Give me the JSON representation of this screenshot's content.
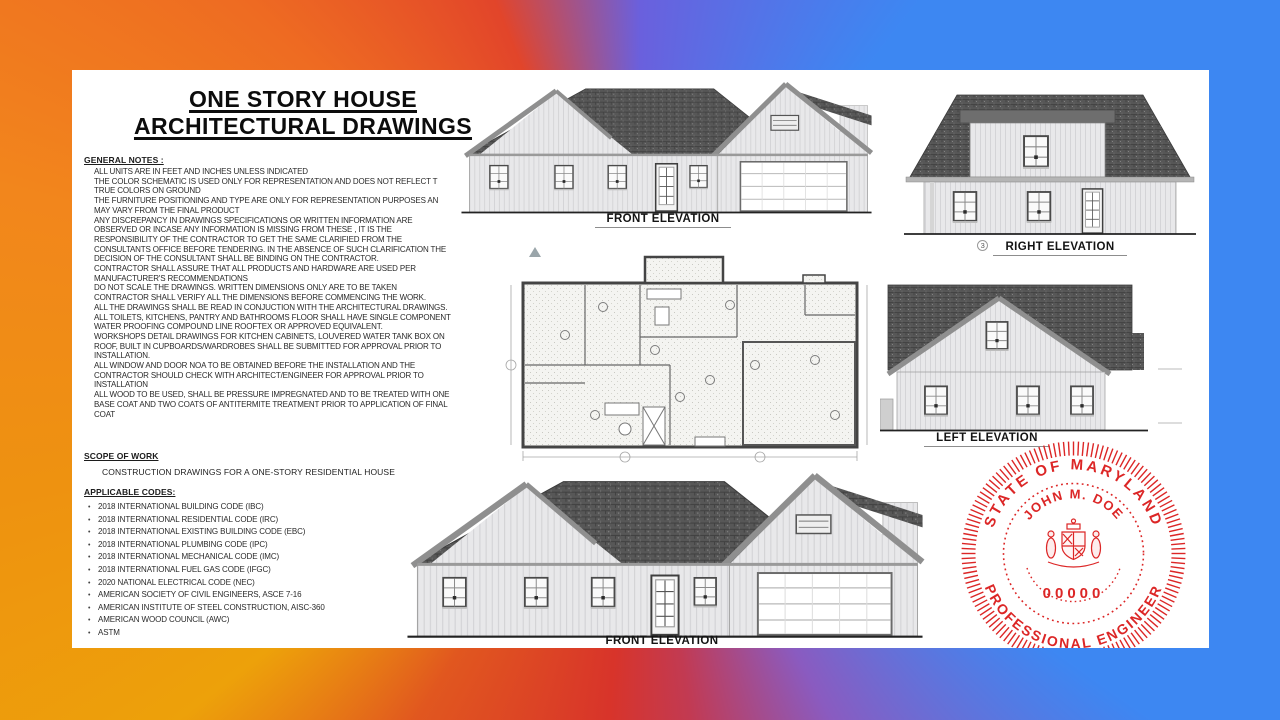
{
  "page": {
    "title_line1": "ONE STORY HOUSE",
    "title_line2": "ARCHITECTURAL DRAWINGS"
  },
  "general_notes": {
    "heading": "GENERAL NOTES :",
    "lines": [
      "ALL UNITS ARE IN FEET AND INCHES UNLESS INDICATED",
      "THE COLOR SCHEMATIC IS USED ONLY FOR REPRESENTATION AND DOES NOT REFLECT T",
      "TRUE COLORS ON GROUND",
      "THE FURNITURE POSITIONING AND TYPE ARE ONLY FOR REPRESENTATION PURPOSES AN",
      "MAY VARY FROM THE FINAL PRODUCT",
      "ANY DISCREPANCY IN DRAWINGS SPECIFICATIONS OR WRITTEN INFORMATION ARE",
      "OBSERVED OR INCASE ANY INFORMATION IS MISSING FROM THESE , IT IS THE",
      "RESPONSIBILITY OF THE CONTRACTOR TO GET THE SAME CLARIFIED FROM THE",
      "CONSULTANTS OFFICE BEFORE TENDERING. IN THE ABSENCE OF SUCH CLARIFICATION THE",
      "DECISION OF THE CONSULTANT SHALL BE BINDING ON THE CONTRACTOR.",
      "CONTRACTOR SHALL ASSURE THAT ALL PRODUCTS AND HARDWARE ARE USED PER",
      "MANUFACTURER'S RECOMMENDATIONS",
      "DO NOT SCALE THE DRAWINGS. WRITTEN DIMENSIONS ONLY ARE TO BE TAKEN",
      "CONTRACTOR SHALL VERIFY ALL THE DIMENSIONS BEFORE COMMENCING THE WORK.",
      "ALL THE DRAWINGS SHALL BE READ IN CONJUCTION WITH THE ARCHITECTURAL DRAWINGS.",
      "ALL TOILETS, KITCHENS, PANTRY AND BATHROOMS FLOOR SHALL HAVE SINGLE COMPONENT",
      "WATER PROOFING COMPOUND LINE ROOFTEX OR APPROVED EQUIVALENT.",
      "WORKSHOPS DETAIL DRAWINGS FOR KITCHEN CABINETS, LOUVERED WATER TANK BOX ON",
      "ROOF, BUILT IN CUPBOARDS/WARDROBES SHALL BE SUBMITTED FOR APPROVAL PRIOR TO",
      "INSTALLATION.",
      "ALL WINDOW AND DOOR NOA TO BE OBTAINED BEFORE THE INSTALLATION AND THE",
      "CONTRACTOR SHOULD CHECK WITH ARCHITECT/ENGINEER FOR APPROVAL PRIOR TO",
      "INSTALLATION",
      "ALL WOOD TO BE USED, SHALL BE PRESSURE IMPREGNATED AND TO BE TREATED WITH ONE",
      "BASE COAT AND TWO COATS OF ANTITERMITE TREATMENT PRIOR TO APPLICATION OF FINAL",
      "COAT"
    ]
  },
  "scope_of_work": {
    "heading": "SCOPE OF WORK",
    "body": "CONSTRUCTION DRAWINGS FOR A ONE-STORY RESIDENTIAL HOUSE"
  },
  "applicable_codes": {
    "heading": "APPLICABLE CODES:",
    "bullet": "•",
    "items": [
      "2018 INTERNATIONAL BUILDING CODE (IBC)",
      "2018 INTERNATIONAL RESIDENTIAL CODE (IRC)",
      "2018 INTERNATIONAL EXISTING BUILDING CODE (EBC)",
      "2018 INTERNATIONAL PLUMBING CODE (IPC)",
      "2018 INTERNATIONAL MECHANICAL CODE (IMC)",
      "2018 INTERNATIONAL FUEL GAS CODE (IFGC)",
      "2020 NATIONAL ELECTRICAL CODE (NEC)",
      "AMERICAN SOCIETY OF CIVIL ENGINEERS, ASCE 7-16",
      "AMERICAN INSTITUTE OF STEEL CONSTRUCTION, AISC-360",
      "AMERICAN WOOD COUNCIL (AWC)",
      "ASTM"
    ]
  },
  "drawings": {
    "front_elevation_top": {
      "label": "FRONT ELEVATION"
    },
    "right_elevation": {
      "label": "RIGHT ELEVATION",
      "marker": "3"
    },
    "left_elevation": {
      "label": "LEFT ELEVATION"
    },
    "front_elevation_bottom": {
      "label": "FRONT ELEVATION"
    }
  },
  "stamp": {
    "arc_top": "STATE OF MARYLAND",
    "name": "JOHN M. DOE",
    "license_number": "00000",
    "arc_bottom": "PROFESSIONAL ENGINEER",
    "color": "#dc2626"
  },
  "colors": {
    "border_orange": "#f2861c",
    "border_amber": "#eda10a",
    "border_red": "#d8342a",
    "border_blue": "#3d87f2",
    "border_purple": "#6a60dd",
    "roof_gray": "#575757",
    "stamp_red": "#dc2626"
  }
}
